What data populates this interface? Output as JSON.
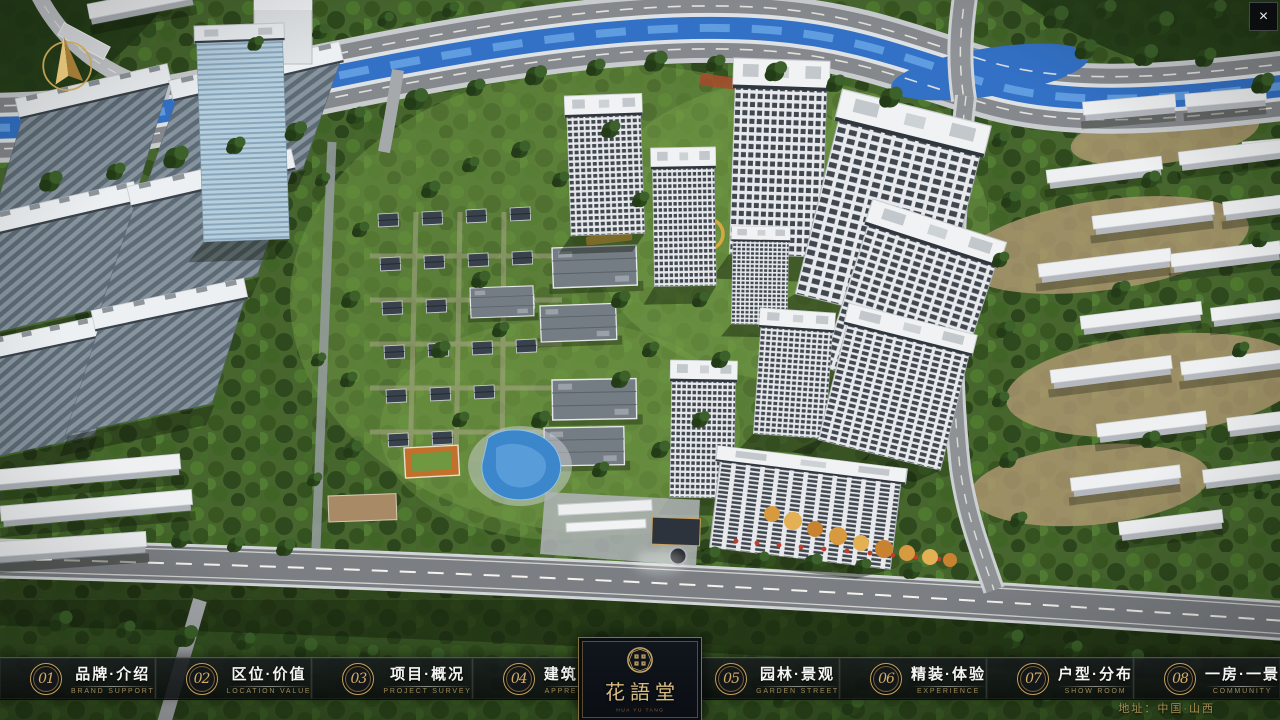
{
  "window": {
    "close_icon": "×"
  },
  "nav": {
    "items": [
      {
        "number": "01",
        "title": "品牌·介绍",
        "subtitle": "BRAND SUPPORT"
      },
      {
        "number": "02",
        "title": "区位·价值",
        "subtitle": "LOCATION VALUE"
      },
      {
        "number": "03",
        "title": "项目·概况",
        "subtitle": "PROJECT SURVEY"
      },
      {
        "number": "04",
        "title": "建筑·鉴赏",
        "subtitle": "APPRECIATION"
      },
      {
        "number": "05",
        "title": "园林·景观",
        "subtitle": "GARDEN STREET"
      },
      {
        "number": "06",
        "title": "精装·体验",
        "subtitle": "EXPERIENCE"
      },
      {
        "number": "07",
        "title": "户型·分布",
        "subtitle": "SHOW ROOM"
      },
      {
        "number": "08",
        "title": "一房·一景",
        "subtitle": "COMMUNITY"
      }
    ]
  },
  "logo": {
    "name": "花語堂",
    "caption": "HUA YU TANG"
  },
  "footer": {
    "address": "地址：中国·山西"
  },
  "icons": {
    "close": "close-icon",
    "compass": "compass-icon",
    "seal": "seal-emblem-icon"
  },
  "colors": {
    "brand_gold": "#c9a05c",
    "nav_text_gold": "#a08a55",
    "nav_bar_bg": "#101316",
    "river_blue": "#3371c6",
    "scene_green": "#4c6a31"
  }
}
